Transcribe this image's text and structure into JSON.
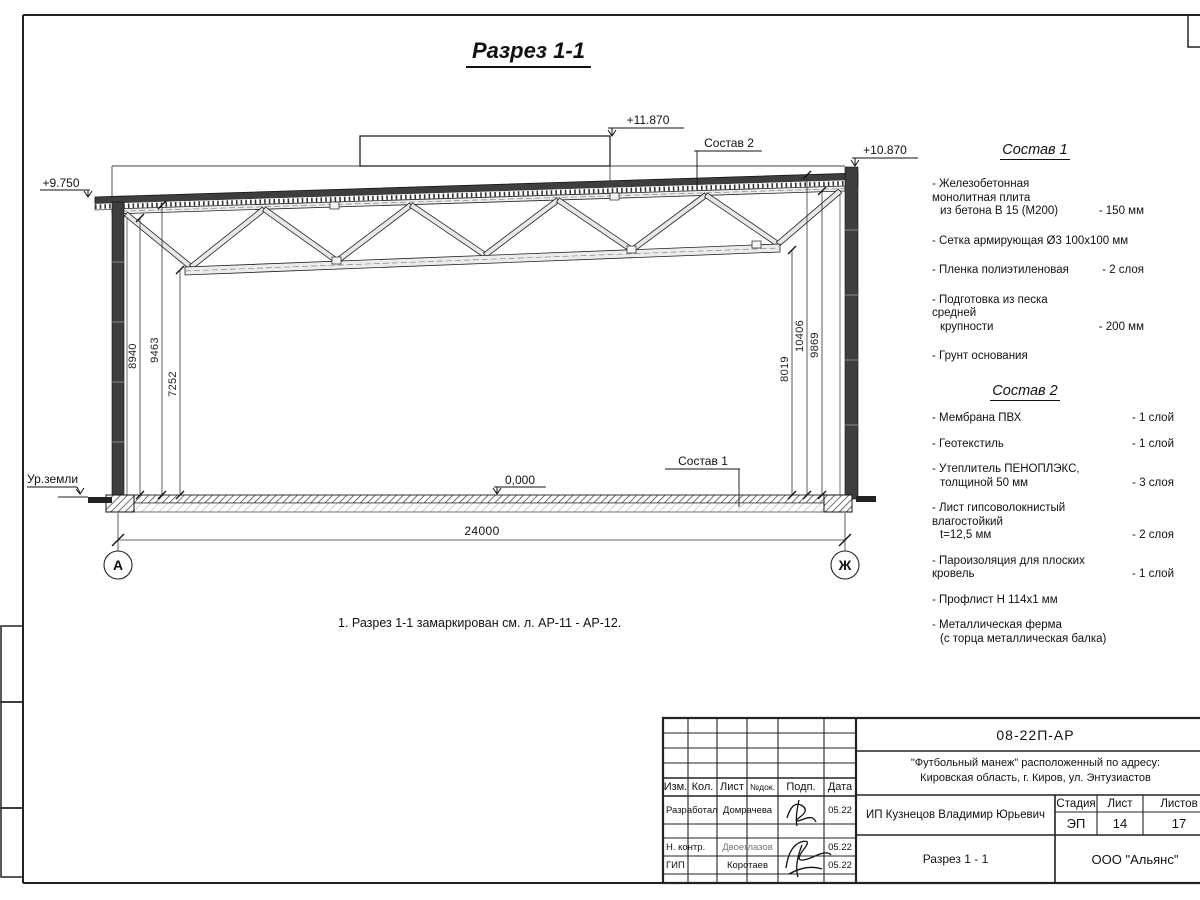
{
  "page": {
    "title": "Разрез 1-1",
    "note": "1. Разрез 1-1 замаркирован см. л. АР-11 - АР-12."
  },
  "drawing": {
    "elevations": {
      "left": "+9.750",
      "top": "+11.870",
      "right": "+10.870",
      "floor": "0,000"
    },
    "labels": {
      "ground": "Ур.земли",
      "comp1": "Состав 1",
      "comp2": "Состав 2"
    },
    "dims": {
      "left": [
        "8940",
        "9463",
        "7252"
      ],
      "right": [
        "8019",
        "10406",
        "9869"
      ],
      "span": "24000"
    },
    "axes": [
      "А",
      "Ж"
    ]
  },
  "composition1": {
    "title": "Состав 1",
    "items": [
      {
        "lines": [
          "- Железобетонная  монолитная плита",
          "из бетона В 15 (М200)"
        ],
        "amount": "- 150 мм"
      },
      {
        "lines": [
          "- Сетка армирующая Ø3 100х100 мм"
        ],
        "amount": ""
      },
      {
        "lines": [
          "- Пленка полиэтиленовая"
        ],
        "amount": "- 2 слоя"
      },
      {
        "lines": [
          "- Подготовка из песка средней",
          "крупности"
        ],
        "amount": "- 200 мм"
      },
      {
        "lines": [
          "- Грунт основания"
        ],
        "amount": ""
      }
    ]
  },
  "composition2": {
    "title": "Состав 2",
    "items": [
      {
        "lines": [
          "- Мембрана ПВХ"
        ],
        "amount": "- 1 слой"
      },
      {
        "lines": [
          "- Геотекстиль"
        ],
        "amount": "- 1 слой"
      },
      {
        "lines": [
          "- Утеплитель ПЕНОПЛЭКС,",
          "толщиной 50 мм"
        ],
        "amount": "- 3 слоя"
      },
      {
        "lines": [
          "- Лист гипсоволокнистый влагостойкий",
          "t=12,5 мм"
        ],
        "amount": "- 2 слоя"
      },
      {
        "lines": [
          "- Пароизоляция для плоских кровель"
        ],
        "amount": "- 1 слой"
      },
      {
        "lines": [
          "- Профлист Н 114х1 мм"
        ],
        "amount": ""
      },
      {
        "lines": [
          "- Металлическая ферма",
          "(с торца металлическая балка)"
        ],
        "amount": ""
      }
    ]
  },
  "titleblock": {
    "doc_code": "08-22П-АР",
    "project_line1": "\"Футбольный манеж\" расположенный по адресу:",
    "project_line2": "Кировская область, г. Киров, ул. Энтузиастов",
    "client": "ИП Кузнецов Владимир Юрьевич",
    "sheet_title": "Разрез 1 - 1",
    "org": "ООО \"Альянс\"",
    "cols": [
      "Изм.",
      "Кол.",
      "Лист",
      "№док.",
      "Подп.",
      "Дата"
    ],
    "stage_label": "Стадия",
    "sheet_label": "Лист",
    "sheets_label": "Листов",
    "stage": "ЭП",
    "sheet": "14",
    "sheets": "17",
    "rows": [
      {
        "role": "Разработал",
        "name": "Домрачева",
        "date": "05.22"
      },
      {
        "role": "Н. контр.",
        "name": "Двоеглазов",
        "date": "05.22"
      },
      {
        "role": "ГИП",
        "name": "Коротаев",
        "date": "05.22"
      }
    ]
  }
}
